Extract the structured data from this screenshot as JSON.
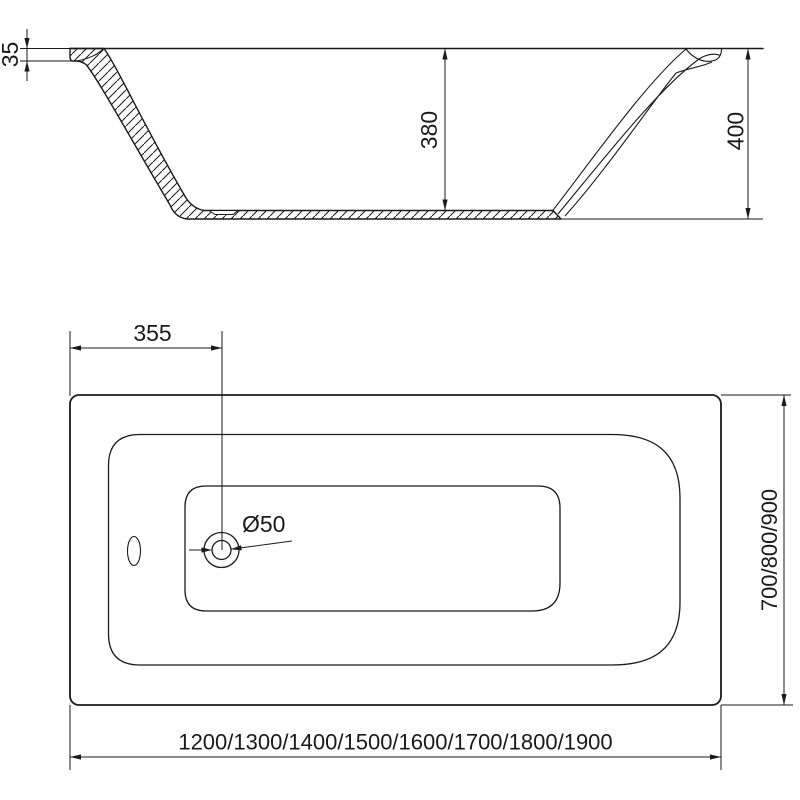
{
  "drawing": {
    "background": "#ffffff",
    "line_color": "#1a1a1a",
    "section_view": {
      "rim_drop": "35",
      "inner_depth": "380",
      "overall_height": "400"
    },
    "plan_view": {
      "drain_offset": "355",
      "drain_diameter": "Ø50",
      "width_options": "700/800/900",
      "length_options": "1200/1300/1400/1500/1600/1700/1800/1900"
    }
  }
}
